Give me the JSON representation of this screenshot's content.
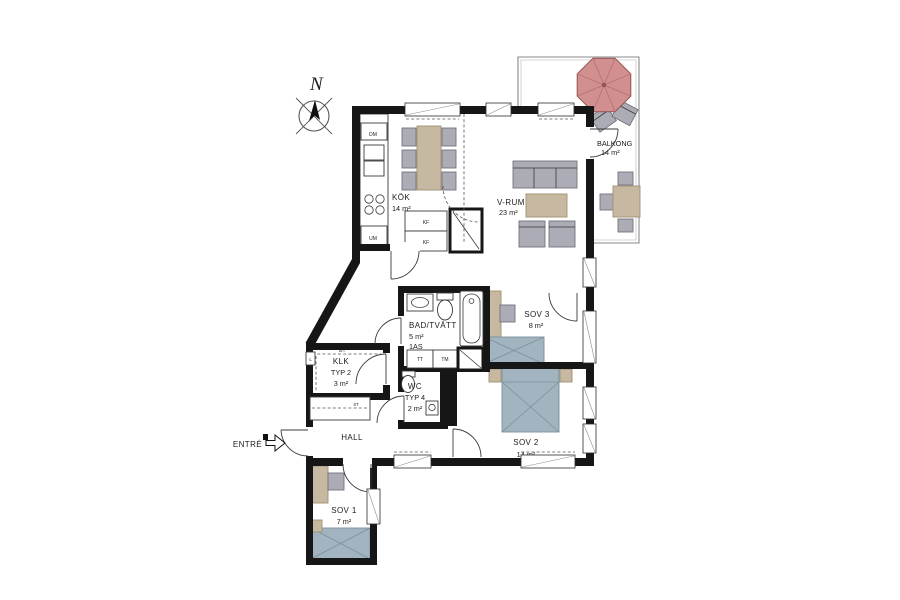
{
  "compass": {
    "north": "N"
  },
  "entrance": {
    "label": "ENTRÉ"
  },
  "rooms": {
    "kok": {
      "name": "KÖK",
      "area": "14 m²"
    },
    "vrum": {
      "name": "V-RUM",
      "area": "23 m²"
    },
    "balkong": {
      "name": "BALKONG",
      "area": "14 m²"
    },
    "bad": {
      "name": "BAD/TVÄTT",
      "area": "5 m²",
      "note": "1AS"
    },
    "sov3": {
      "name": "SOV 3",
      "area": "8 m²"
    },
    "klk": {
      "name": "KLK",
      "type": "TYP 2",
      "area": "3 m²"
    },
    "wc": {
      "name": "WC",
      "type": "TYP 4",
      "area": "2 m²"
    },
    "hall": {
      "name": "HALL"
    },
    "sov2": {
      "name": "SOV 2",
      "area": "14 m²"
    },
    "sov1": {
      "name": "SOV 1",
      "area": "7 m²"
    }
  },
  "appliances": {
    "dm": "DM",
    "um": "UM",
    "kf_upper": "KF",
    "kf_lower": "KF",
    "tt": "TT",
    "tm": "TM",
    "st": "ST",
    "linen": "L",
    "klk_shelf": "S/T",
    "kitchen_note": "NED.TAK"
  },
  "colors": {
    "wall": "#161616",
    "furniture_gray": "#abacb5",
    "wood": "#c6b8a1",
    "bed_gray_blue": "#a2b4c0",
    "parasol_red": "#d18f8f"
  }
}
